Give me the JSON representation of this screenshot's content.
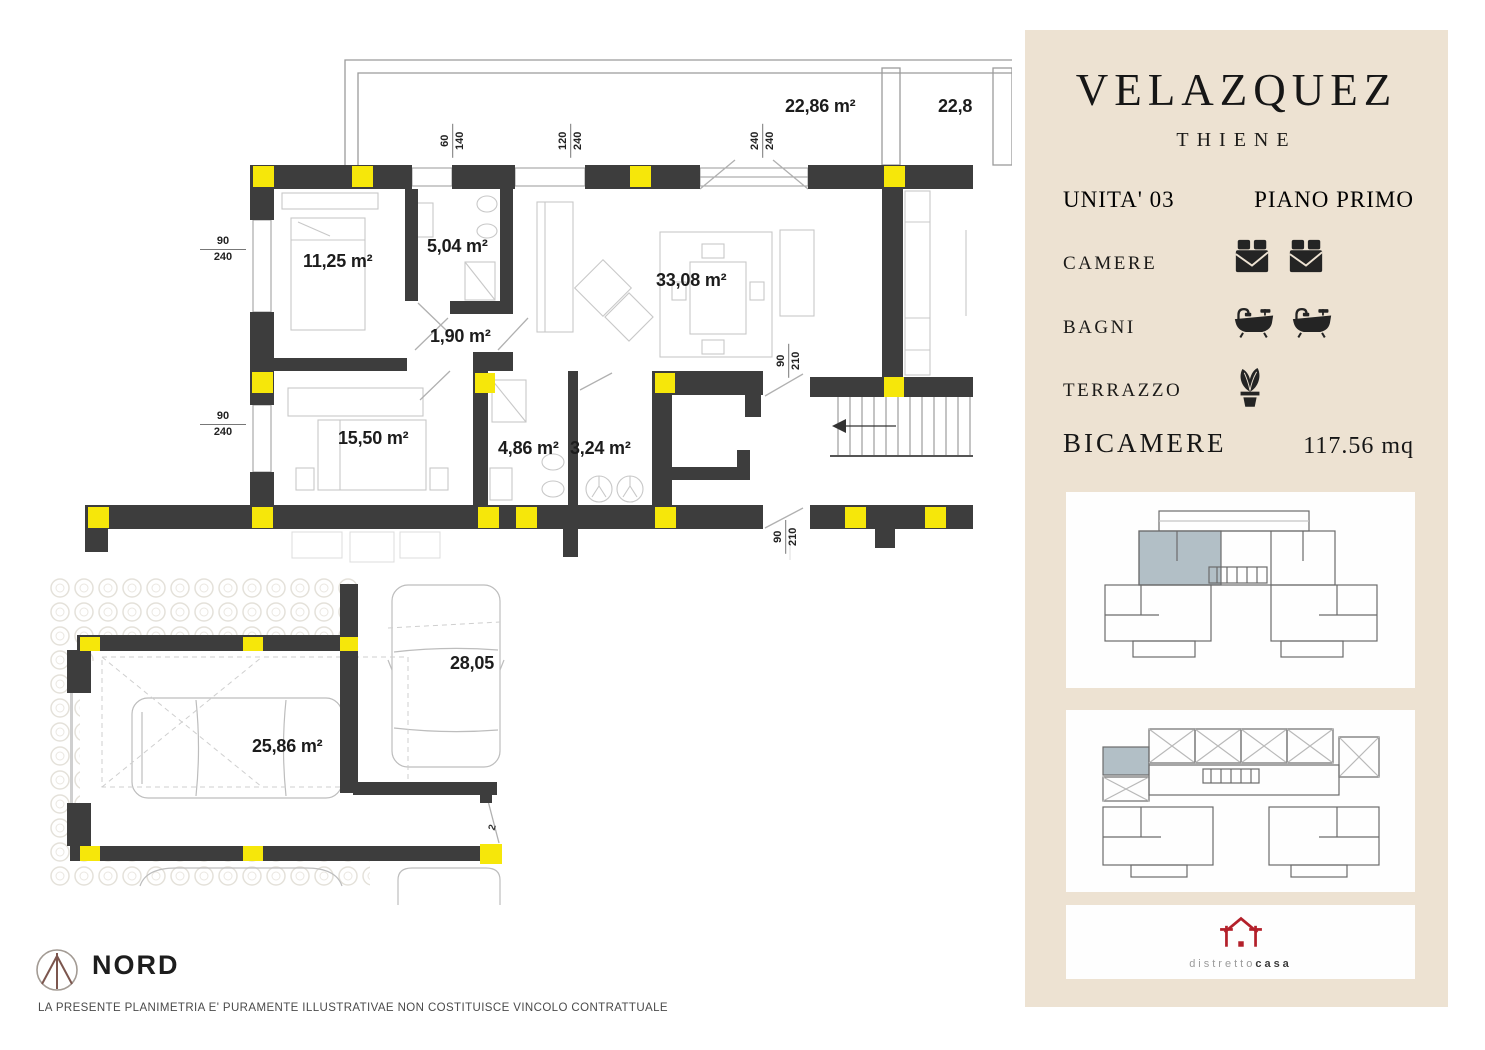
{
  "panel": {
    "title": "VELAZQUEZ",
    "subtitle": "THIENE",
    "unit": "UNITA' 03",
    "floor": "PIANO PRIMO",
    "features": [
      {
        "label": "CAMERE",
        "count": 2,
        "icon": "bed-icon"
      },
      {
        "label": "BAGNI",
        "count": 2,
        "icon": "bathtub-icon"
      },
      {
        "label": "TERRAZZO",
        "count": 1,
        "icon": "plant-icon"
      }
    ],
    "type": "BICAMERE",
    "area": "117.56 mq",
    "logo_light": "distretto",
    "logo_bold": "casa"
  },
  "plan": {
    "rooms": [
      {
        "name": "terrazzo-1",
        "label": "22,86 m²"
      },
      {
        "name": "terrazzo-2",
        "label": "22,8"
      },
      {
        "name": "camera-1",
        "label": "11,25 m²"
      },
      {
        "name": "bagno-1",
        "label": "5,04 m²"
      },
      {
        "name": "disimpegno",
        "label": "1,90 m²"
      },
      {
        "name": "soggiorno",
        "label": "33,08 m²"
      },
      {
        "name": "camera-2",
        "label": "15,50 m²"
      },
      {
        "name": "bagno-2",
        "label": "4,86 m²"
      },
      {
        "name": "lavanderia",
        "label": "3,24 m²"
      },
      {
        "name": "garage",
        "label": "25,86 m²"
      },
      {
        "name": "posto-auto",
        "label": "28,05"
      }
    ],
    "dims": [
      {
        "a": "60",
        "b": "140"
      },
      {
        "a": "120",
        "b": "240"
      },
      {
        "a": "240",
        "b": "240"
      },
      {
        "a": "90",
        "b": "240"
      },
      {
        "a": "90",
        "b": "240"
      },
      {
        "a": "90",
        "b": "210"
      },
      {
        "a": "90",
        "b": "210"
      },
      {
        "a": "2",
        "b": ""
      }
    ],
    "north_label": "NORD",
    "disclaimer": "LA PRESENTE PLANIMETRIA E' PURAMENTE ILLUSTRATIVAE NON COSTITUISCE VINCOLO CONTRATTUALE"
  },
  "colors": {
    "wall": "#3d3d3d",
    "accent_yellow": "#f6e70a",
    "panel_bg": "#ede2d2",
    "keyplan_highlight": "#b2bfc6",
    "logo_red": "#b3202a"
  }
}
